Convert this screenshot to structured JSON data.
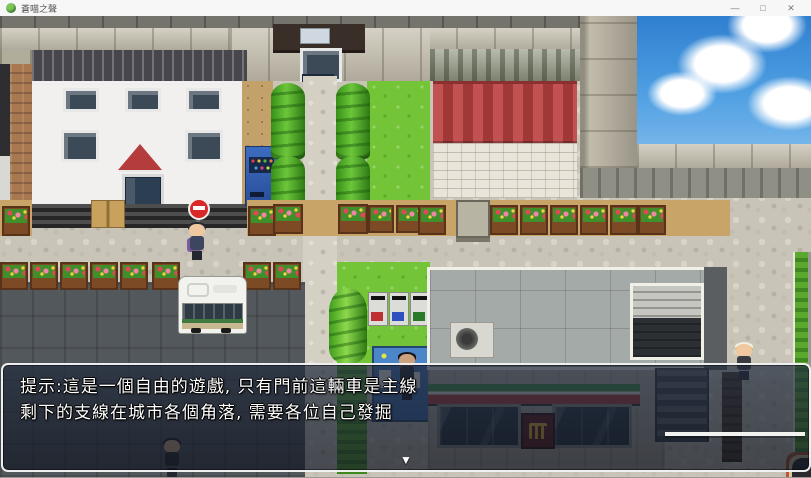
{
  "window": {
    "title": "蒼喵之聲",
    "controls": {
      "minimize": "—",
      "maximize": "□",
      "close": "✕"
    }
  },
  "dialog": {
    "line1": "提示:這是一個自由的遊戲, 只有門前這輛車是主線",
    "line2": "剩下的支線在城市各個角落, 需要各位自己發掘",
    "continue_indicator": "▼"
  },
  "scene": {
    "type": "rpg-maker-town-map",
    "colors": {
      "sky": "#2f7fd0",
      "grass": "#74c437",
      "awning_red": "#b43c3c",
      "store_stripe_green": "#3f8f42",
      "store_stripe_red": "#b03a3a",
      "road_asphalt": "#53585c",
      "cobblestone": "#c9c4b8",
      "dialog_border": "#ffffff"
    }
  }
}
